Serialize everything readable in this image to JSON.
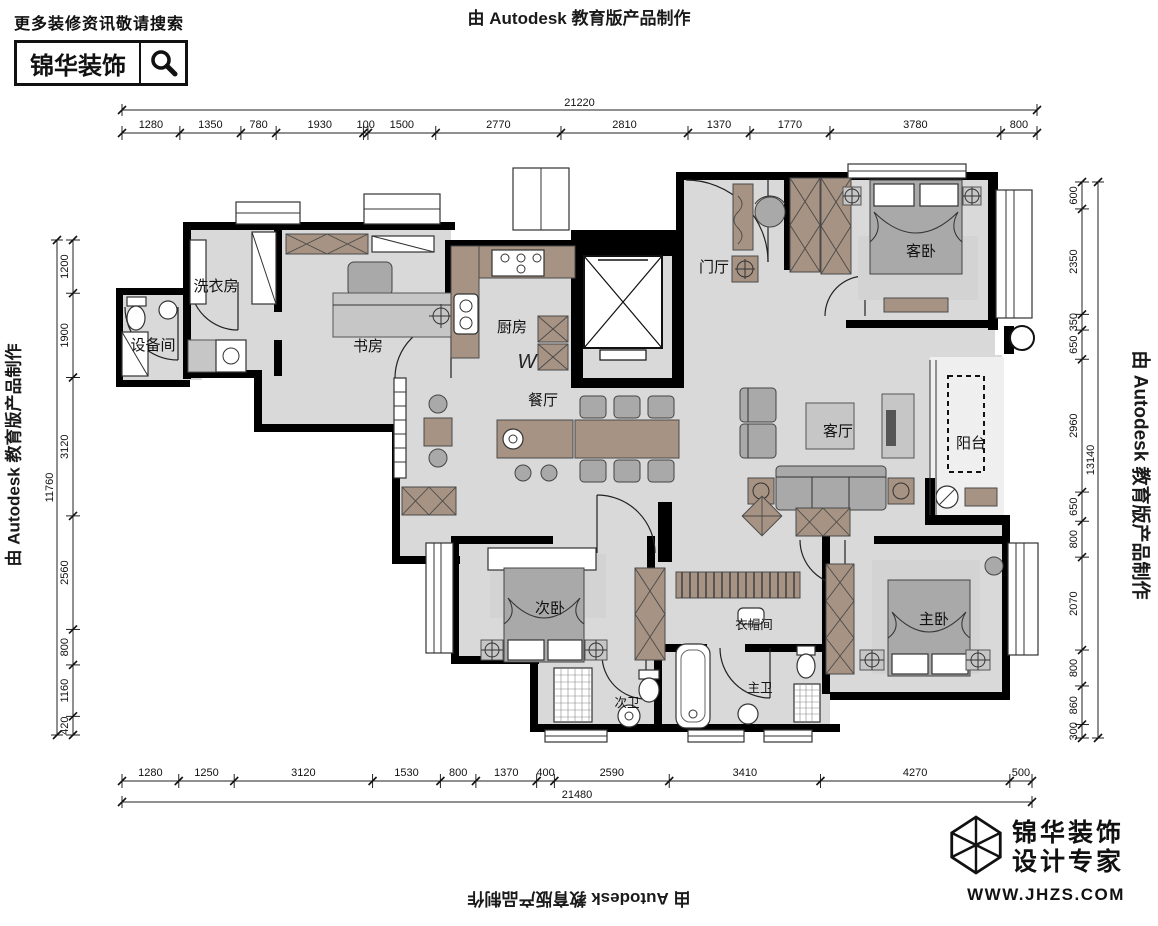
{
  "branding": {
    "search_hint": "更多装修资讯敬请搜索",
    "brand_name": "锦华装饰",
    "footer_line1": "锦华装饰",
    "footer_line2": "设计专家",
    "website": "WWW.JHZS.COM"
  },
  "watermark": {
    "text": "由 Autodesk 教育版产品制作"
  },
  "rooms": [
    {
      "label": "洗衣房"
    },
    {
      "label": "设备间"
    },
    {
      "label": "书房"
    },
    {
      "label": "厨房"
    },
    {
      "label": "餐厅"
    },
    {
      "label": "门厅"
    },
    {
      "label": "客卧"
    },
    {
      "label": "客厅"
    },
    {
      "label": "阳台"
    },
    {
      "label": "次卧"
    },
    {
      "label": "衣帽间"
    },
    {
      "label": "主卧"
    },
    {
      "label": "次卫"
    },
    {
      "label": "主卫"
    }
  ],
  "plan": {
    "washer_symbol": "W"
  },
  "dimensions": {
    "top": {
      "total": "21220",
      "segments": [
        "1280",
        "1350",
        "780",
        "1930",
        "100",
        "1500",
        "2770",
        "2810",
        "1370",
        "1770",
        "3780",
        "800"
      ]
    },
    "bottom": {
      "total": "21480",
      "segments": [
        "1280",
        "1250",
        "3120",
        "1530",
        "800",
        "1370",
        "400",
        "2590",
        "3410",
        "4270",
        "500"
      ]
    },
    "left": {
      "total": "11760",
      "segments": [
        "1200",
        "1900",
        "3120",
        "2560",
        "800",
        "1160",
        "420"
      ]
    },
    "right": {
      "total": "13140",
      "segments": [
        "600",
        "2350",
        "350",
        "650",
        "2960",
        "650",
        "800",
        "2070",
        "800",
        "860",
        "300"
      ]
    }
  },
  "colors": {
    "wall": "#000000",
    "floor": "#d9d9d9",
    "cabinet": "#a69383",
    "furniture_gray": "#a9a9a9"
  }
}
